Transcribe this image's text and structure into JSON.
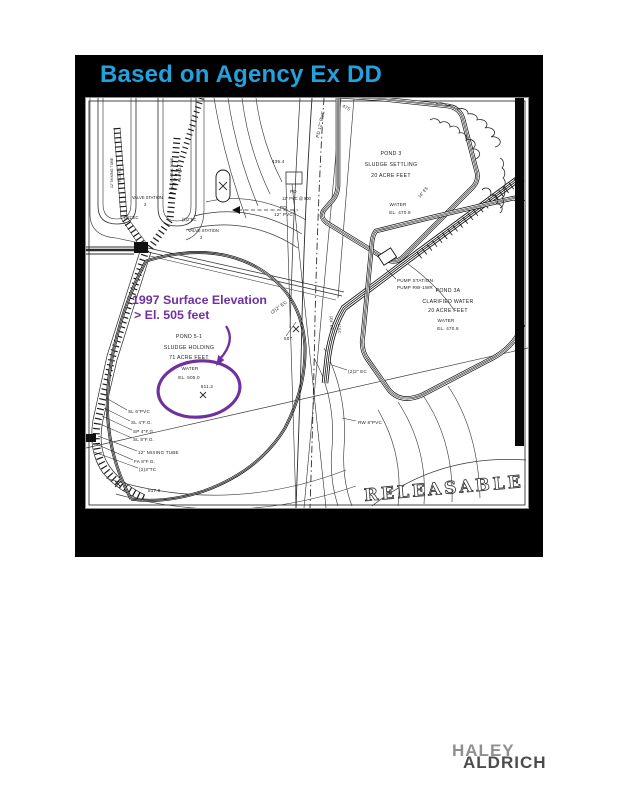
{
  "slide": {
    "title": "Based on Agency Ex DD"
  },
  "annotation": {
    "line1": "1997 Surface Elevation",
    "line2": "> El. 505 feet"
  },
  "ponds": {
    "pond3": {
      "name": "POND 3",
      "type": "SLUDGE SETTLING",
      "capacity": "20 ACRE FEET",
      "water": "WATER",
      "elevation": "EL. 470.8"
    },
    "pond3a": {
      "name": "POND 3A",
      "type": "CLARIFIED WATER",
      "capacity": "20 ACRE FEET",
      "water": "WATER",
      "elevation": "EL. 470.8"
    },
    "pond51": {
      "name": "POND 5-1",
      "type": "SLUDGE HOLDING",
      "capacity": "71 ACRE FEET",
      "water": "WATER",
      "elevation": "EL. 505.0",
      "spot_elevation": "511.2"
    }
  },
  "labels": {
    "pump_station_l1": "PUMP STATION",
    "pump_station_l2": "PUMP RW-1WR",
    "valve_station": "VALVE STATION",
    "valve_3": "3",
    "valve_2": "2",
    "pipe_sl6": "SL 6\"PVC",
    "pipe_sl4": "SL 4\"F.G.",
    "pipe_sp4": "SP 4\"F.G.",
    "pipe_sl8": "SL 8\"F.G.",
    "pipe_mixing": "12\" MIXING TUBE",
    "pipe_fa8": "FA 8\"F.G.",
    "pipe_tc": "(2)3\"TC",
    "spot_5178": "517.8",
    "ec_21": "(2)1\"EC",
    "ec_22": "(2)2\"EC",
    "ec_32": "(3)2\" EC",
    "ec_24": "(2)4\" EC",
    "ec_1": "1\" EC",
    "ec_22b": "(2)2\" EC",
    "rw_8pvc": "RW 8\"PVC",
    "pd": "PD",
    "pd_12pvc900": "12\" PVC @ 900",
    "pd_12pvc": "12\" PVC",
    "pd_vert": "PD 12\" PVC",
    "contour_475": "475",
    "spot_4354": "435.4",
    "spot_507": "507.",
    "es_16": "16\" ES"
  },
  "stamp": "RELEASABLE",
  "logo": {
    "line1": "HALEY",
    "line2": "ALDRICH"
  },
  "colors": {
    "title": "#22a2dc",
    "annotation": "#7030a0",
    "slide_background": "#000000"
  }
}
